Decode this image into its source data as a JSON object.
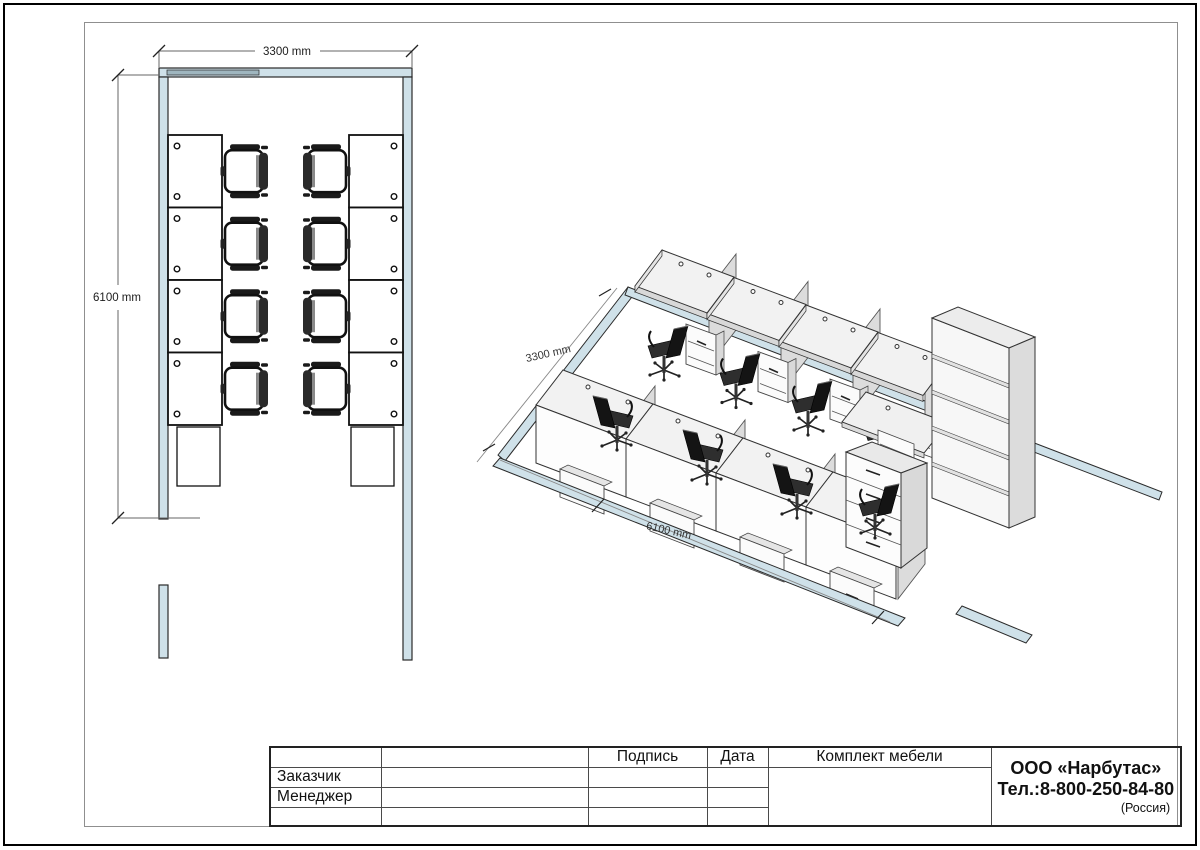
{
  "plan": {
    "dim_width": "3300 mm",
    "dim_length": "6100 mm"
  },
  "iso": {
    "dim_width": "3300 mm",
    "dim_length": "6100 mm"
  },
  "title_block": {
    "col_signature": "Подпись",
    "col_date": "Дата",
    "row_customer": "Заказчик",
    "row_manager": "Менеджер",
    "set_title": "Комплект мебели",
    "company_name": "ООО «Нарбутас»",
    "company_phone": "Тел.:8-800-250-84-80",
    "company_country": "(Россия)"
  },
  "colors": {
    "wall_fill": "#cfe1e9",
    "window_fill": "#9fb6bf",
    "furniture_line": "#111111",
    "dimension_line": "#888888",
    "panel_fill": "#dcdcdc"
  }
}
